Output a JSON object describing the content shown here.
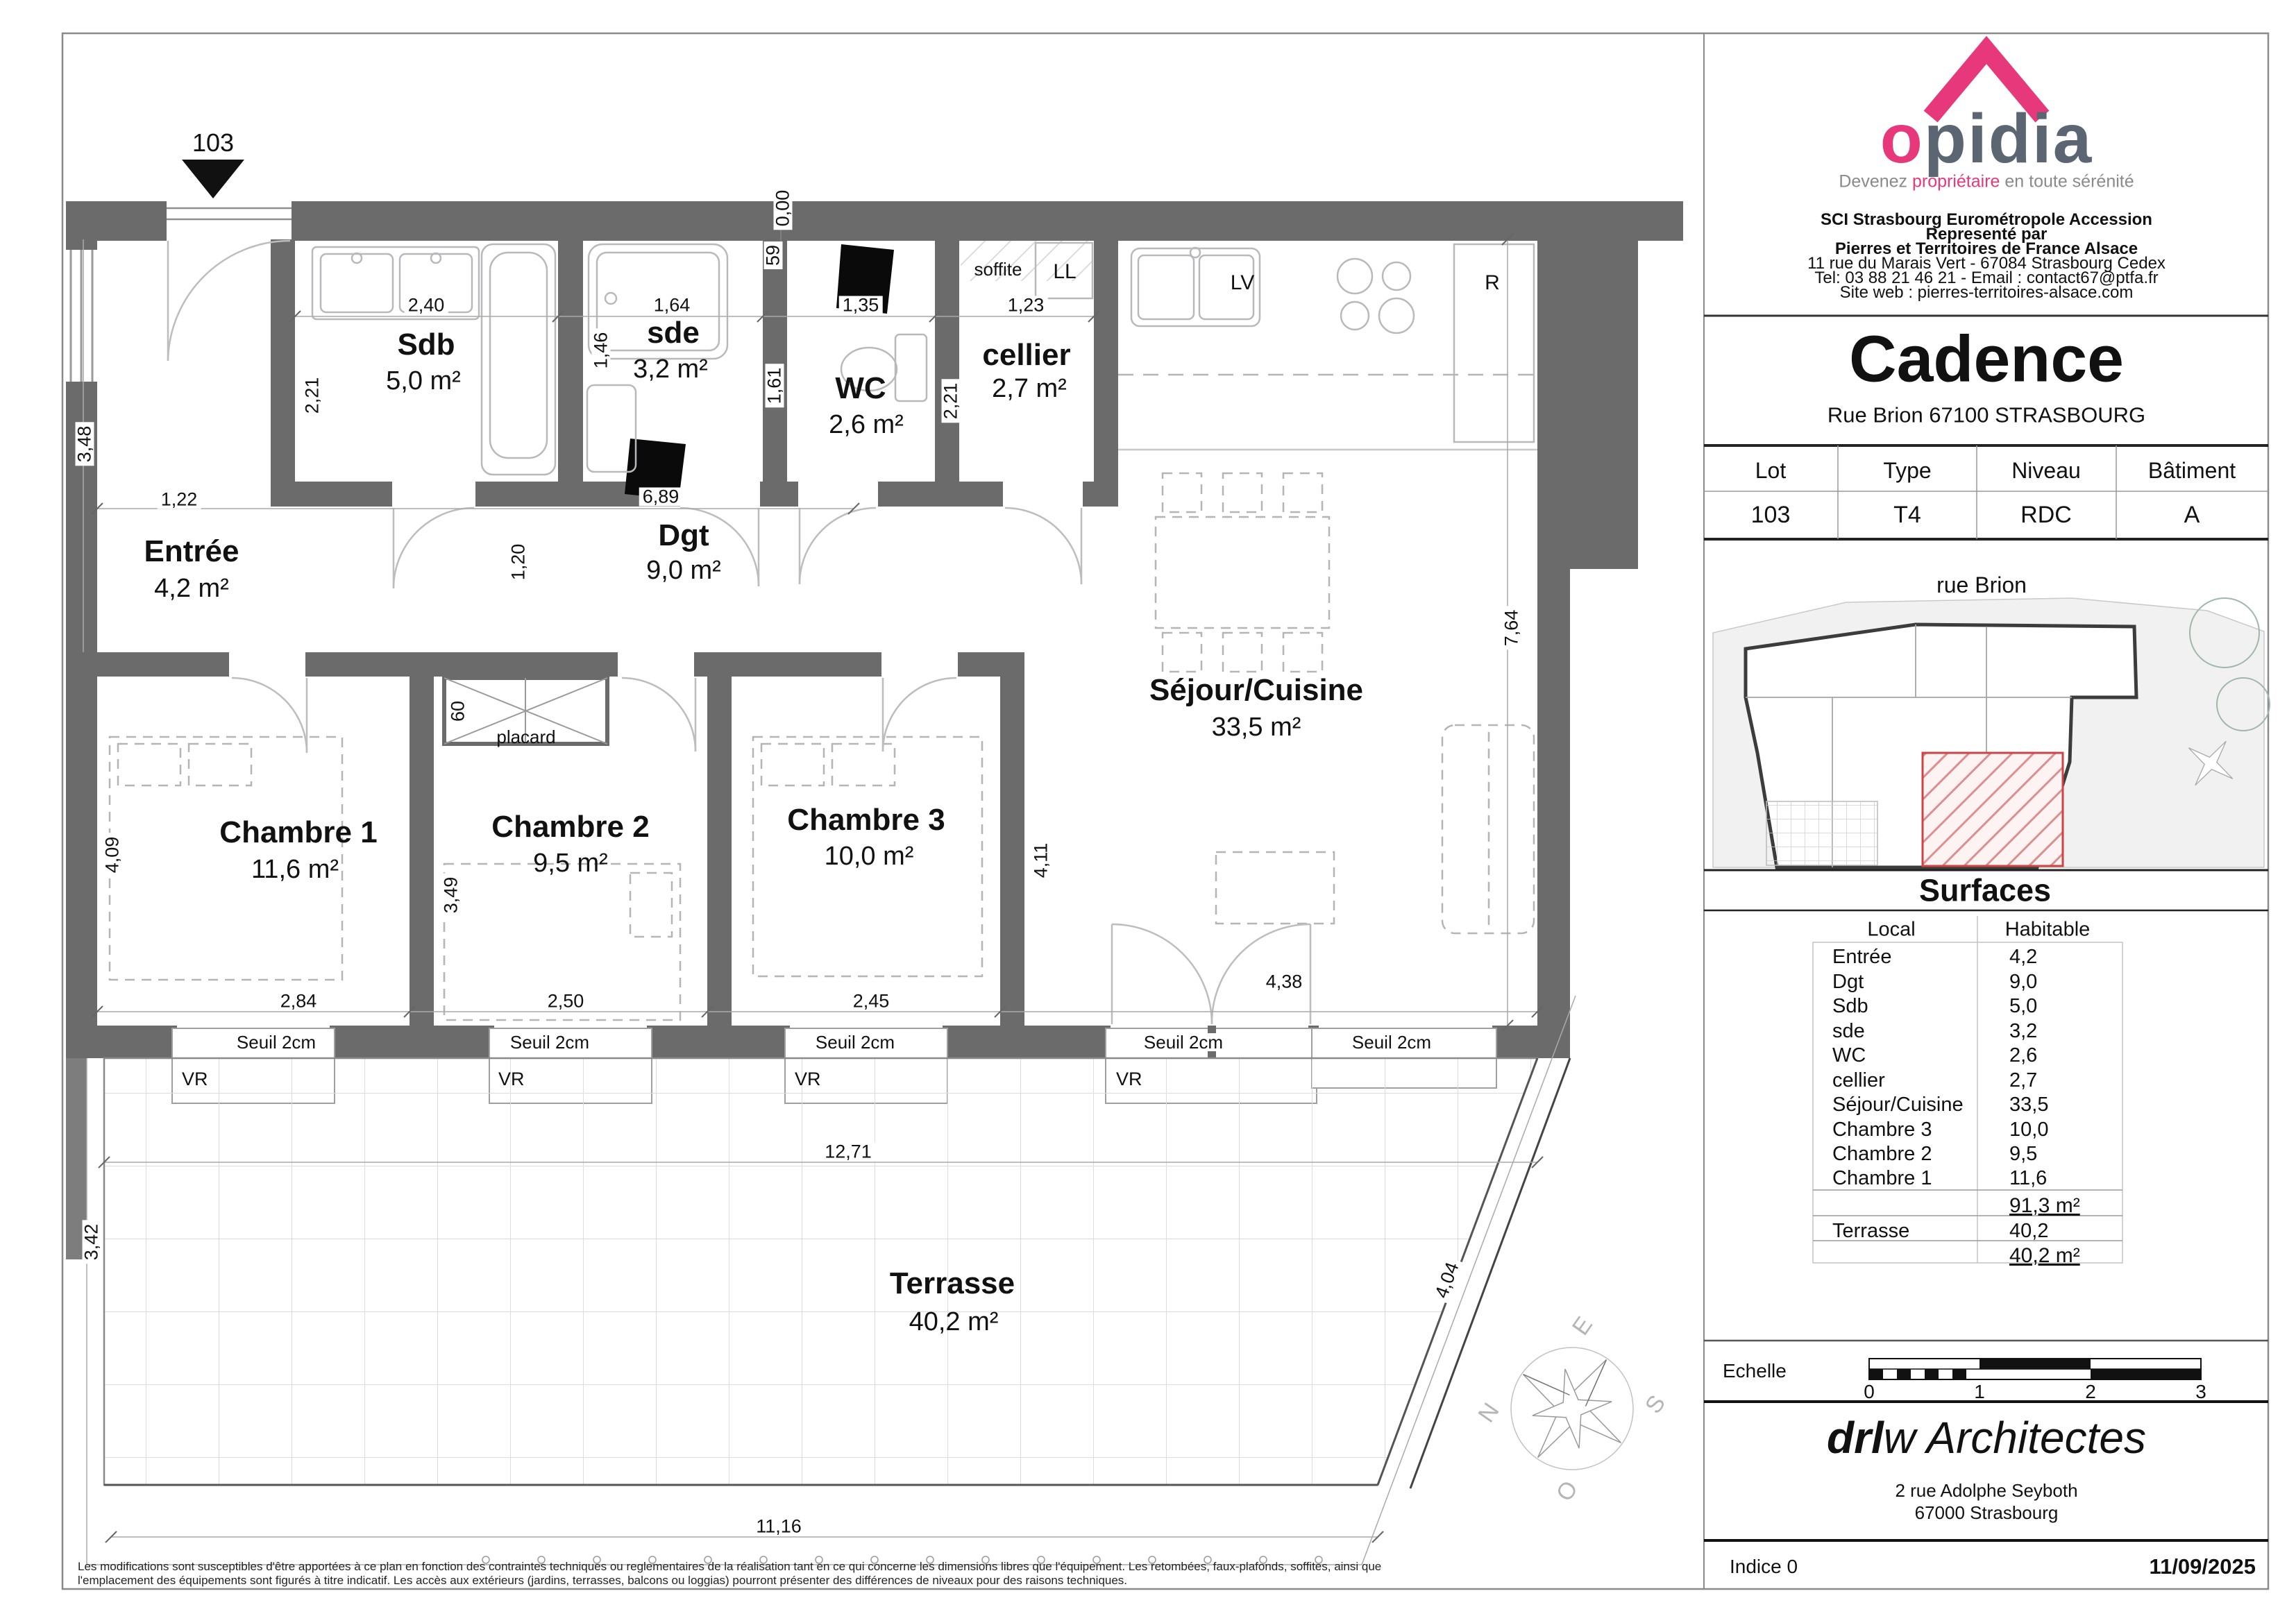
{
  "branding": {
    "logo_first": "o",
    "logo_rest": "pidia",
    "tagline_1": "Devenez ",
    "tagline_accent": "propriétaire",
    "tagline_2": " en toute sérénité",
    "company_lines": [
      "SCI Strasbourg Eurométropole Accession",
      "Representé par",
      "Pierres et Territoires de France Alsace",
      "11 rue du Marais Vert - 67084 Strasbourg Cedex",
      "Tel: 03 88 21 46 21 - Email : contact67@ptfa.fr",
      "Site web : pierres-territoires-alsace.com"
    ]
  },
  "colors": {
    "accent_pink": "#e6387a",
    "logo_slate": "#5b6672",
    "wall_grey": "#6b6b6b",
    "hatch_red": "#cc4444"
  },
  "project": {
    "name": "Cadence",
    "address": "Rue Brion 67100 STRASBOURG"
  },
  "lot_table": {
    "headers": [
      "Lot",
      "Type",
      "Niveau",
      "Bâtiment"
    ],
    "values": [
      "103",
      "T4",
      "RDC",
      "A"
    ]
  },
  "site": {
    "street": "rue Brion"
  },
  "surfaces": {
    "title": "Surfaces",
    "col_local": "Local",
    "col_habitable": "Habitable",
    "rows": [
      {
        "local": "Entrée",
        "value": "4,2"
      },
      {
        "local": "Dgt",
        "value": "9,0"
      },
      {
        "local": "Sdb",
        "value": "5,0"
      },
      {
        "local": "sde",
        "value": "3,2"
      },
      {
        "local": "WC",
        "value": "2,6"
      },
      {
        "local": "cellier",
        "value": "2,7"
      },
      {
        "local": "Séjour/Cuisine",
        "value": "33,5"
      },
      {
        "local": "Chambre 3",
        "value": "10,0"
      },
      {
        "local": "Chambre 2",
        "value": "9,5"
      },
      {
        "local": "Chambre 1",
        "value": "11,6"
      }
    ],
    "total": "91,3 m²",
    "terrace_local": "Terrasse",
    "terrace_value": "40,2",
    "terrace_total": "40,2 m²"
  },
  "scale_bar": {
    "label": "Echelle",
    "ticks": [
      "0",
      "1",
      "2",
      "3"
    ]
  },
  "architect": {
    "name_left": "drl",
    "name_mid": "w",
    "name_right": " Architectes",
    "address1": "2 rue Adolphe Seyboth",
    "address2": "67000 Strasbourg"
  },
  "footer": {
    "indice": "Indice 0",
    "date": "11/09/2025",
    "disclaimer": "Les modifications sont susceptibles d'être apportées à ce plan en fonction des contraintes techniques ou reglementaires de la réalisation tant en ce qui concerne les dimensions libres que l'équipement. Les retombées, faux-plafonds, soffites, ainsi que l'emplacement des équipements sont figurés à titre indicatif. Les accès aux extérieurs (jardins, terrasses, balcons ou loggias) pourront présenter des différences de niveaux pour des raisons techniques."
  },
  "plan": {
    "lot_marker": "103",
    "rooms": [
      {
        "name": "Sdb",
        "area": "5,0 m²"
      },
      {
        "name": "sde",
        "area": "3,2 m²"
      },
      {
        "name": "WC",
        "area": "2,6 m²"
      },
      {
        "name": "cellier",
        "area": "2,7 m²"
      },
      {
        "name": "Entrée",
        "area": "4,2 m²"
      },
      {
        "name": "Dgt",
        "area": "9,0 m²"
      },
      {
        "name": "Chambre 1",
        "area": "11,6 m²"
      },
      {
        "name": "Chambre 2",
        "area": "9,5 m²"
      },
      {
        "name": "Chambre 3",
        "area": "10,0 m²"
      },
      {
        "name": "Séjour/Cuisine",
        "area": "33,5 m²"
      },
      {
        "name": "Terrasse",
        "area": "40,2 m²"
      }
    ],
    "labels": {
      "seuil": "Seuil 2cm",
      "vr": "VR",
      "soffite": "soffite",
      "ll": "LL",
      "lv": "LV",
      "r": "R",
      "placard": "placard"
    },
    "dims": {
      "sdb_w": "2,40",
      "sdb_h": "2,21",
      "entree_h": "3,48",
      "entree_w": "1,22",
      "sde_w": "1,64",
      "sde_h": "1,46",
      "wc_w": "1,35",
      "wc_niche": "59",
      "wc_h": "1,61",
      "zero": "0,00",
      "cellier_w": "1,23",
      "cellier_h": "2,21",
      "band_w": "6,89",
      "dgt_h": "1,20",
      "placard_w": "60",
      "ch1_w": "2,84",
      "ch2_w": "2,50",
      "ch3_w": "2,45",
      "sej_w": "4,38",
      "ch1_h": "4,09",
      "ch2_h": "3,49",
      "ch3_h": "4,11",
      "sej_h": "7,64",
      "terr_w": "12,71",
      "terr_bottom": "11,16",
      "terr_left": "3,42",
      "terr_slant": "4,04"
    },
    "compass": {
      "n": "N",
      "e": "E",
      "s": "S",
      "o": "O"
    }
  }
}
